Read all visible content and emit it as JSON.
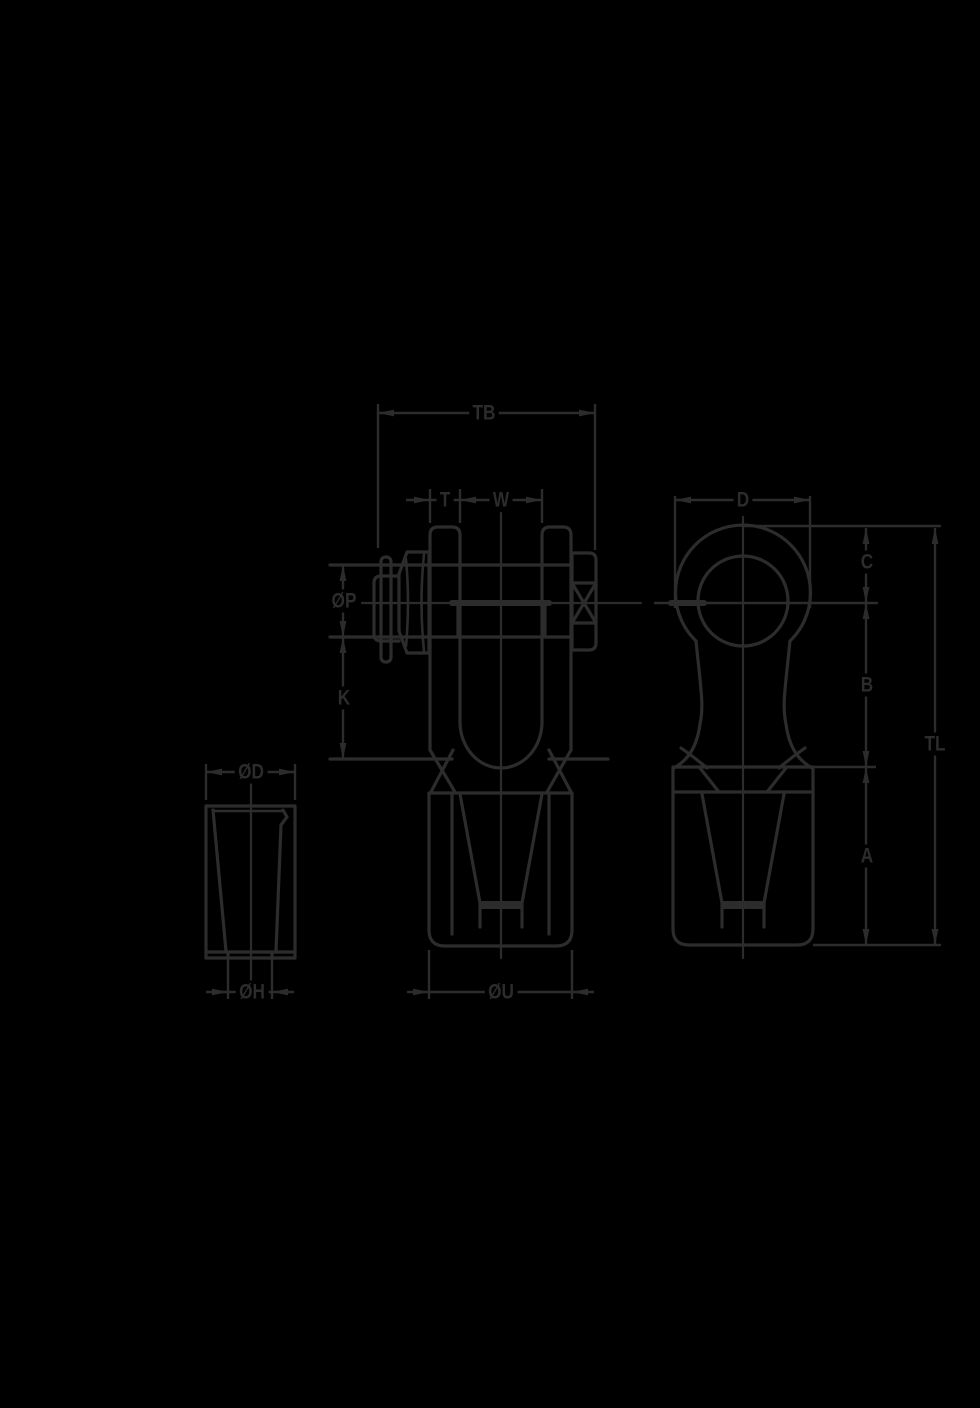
{
  "colors": {
    "background": "#000000",
    "line": "#2c2c2c"
  },
  "labels": {
    "tb": "TB",
    "t": "T",
    "w": "W",
    "p_dia": "ØP",
    "k": "K",
    "d_eye": "D",
    "c": "C",
    "b": "B",
    "a": "A",
    "tl": "TL",
    "d_cone": "ØD",
    "h_cone": "ØH",
    "u_dia": "ØU"
  }
}
